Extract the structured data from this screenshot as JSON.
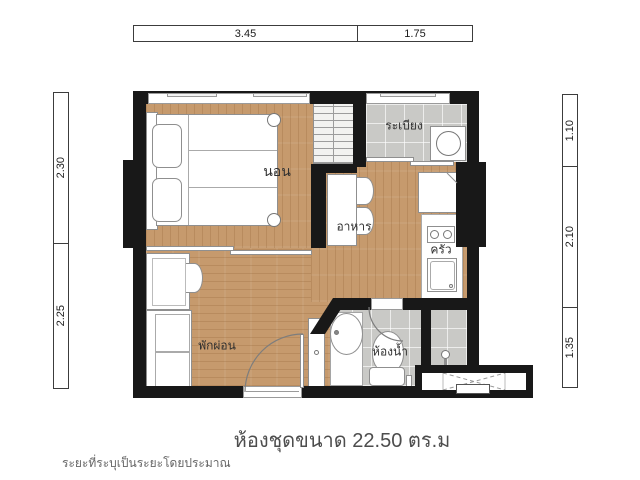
{
  "plan": {
    "rooms": {
      "bedroom": "นอน",
      "balcony": "ระเบียง",
      "dining": "อาหาร",
      "kitchen": "ครัว",
      "living": "พักผ่อน",
      "bathroom": "ห้องน้ำ"
    },
    "dimensions": {
      "top": [
        "3.45",
        "1.75"
      ],
      "left": [
        "2.30",
        "2.25"
      ],
      "right": [
        "1.10",
        "2.10",
        "1.35"
      ]
    },
    "title": "ห้องชุดขนาด  22.50  ตร.ม",
    "footnote": "ระยะที่ระบุเป็นระยะโดยประมาณ",
    "area_sqm": "22.50",
    "colors": {
      "wall": "#181818",
      "wood_floor": "#c69a6d",
      "tile_floor": "#c9c9c6",
      "background": "#ffffff",
      "title_text": "#4d4d4d"
    }
  }
}
